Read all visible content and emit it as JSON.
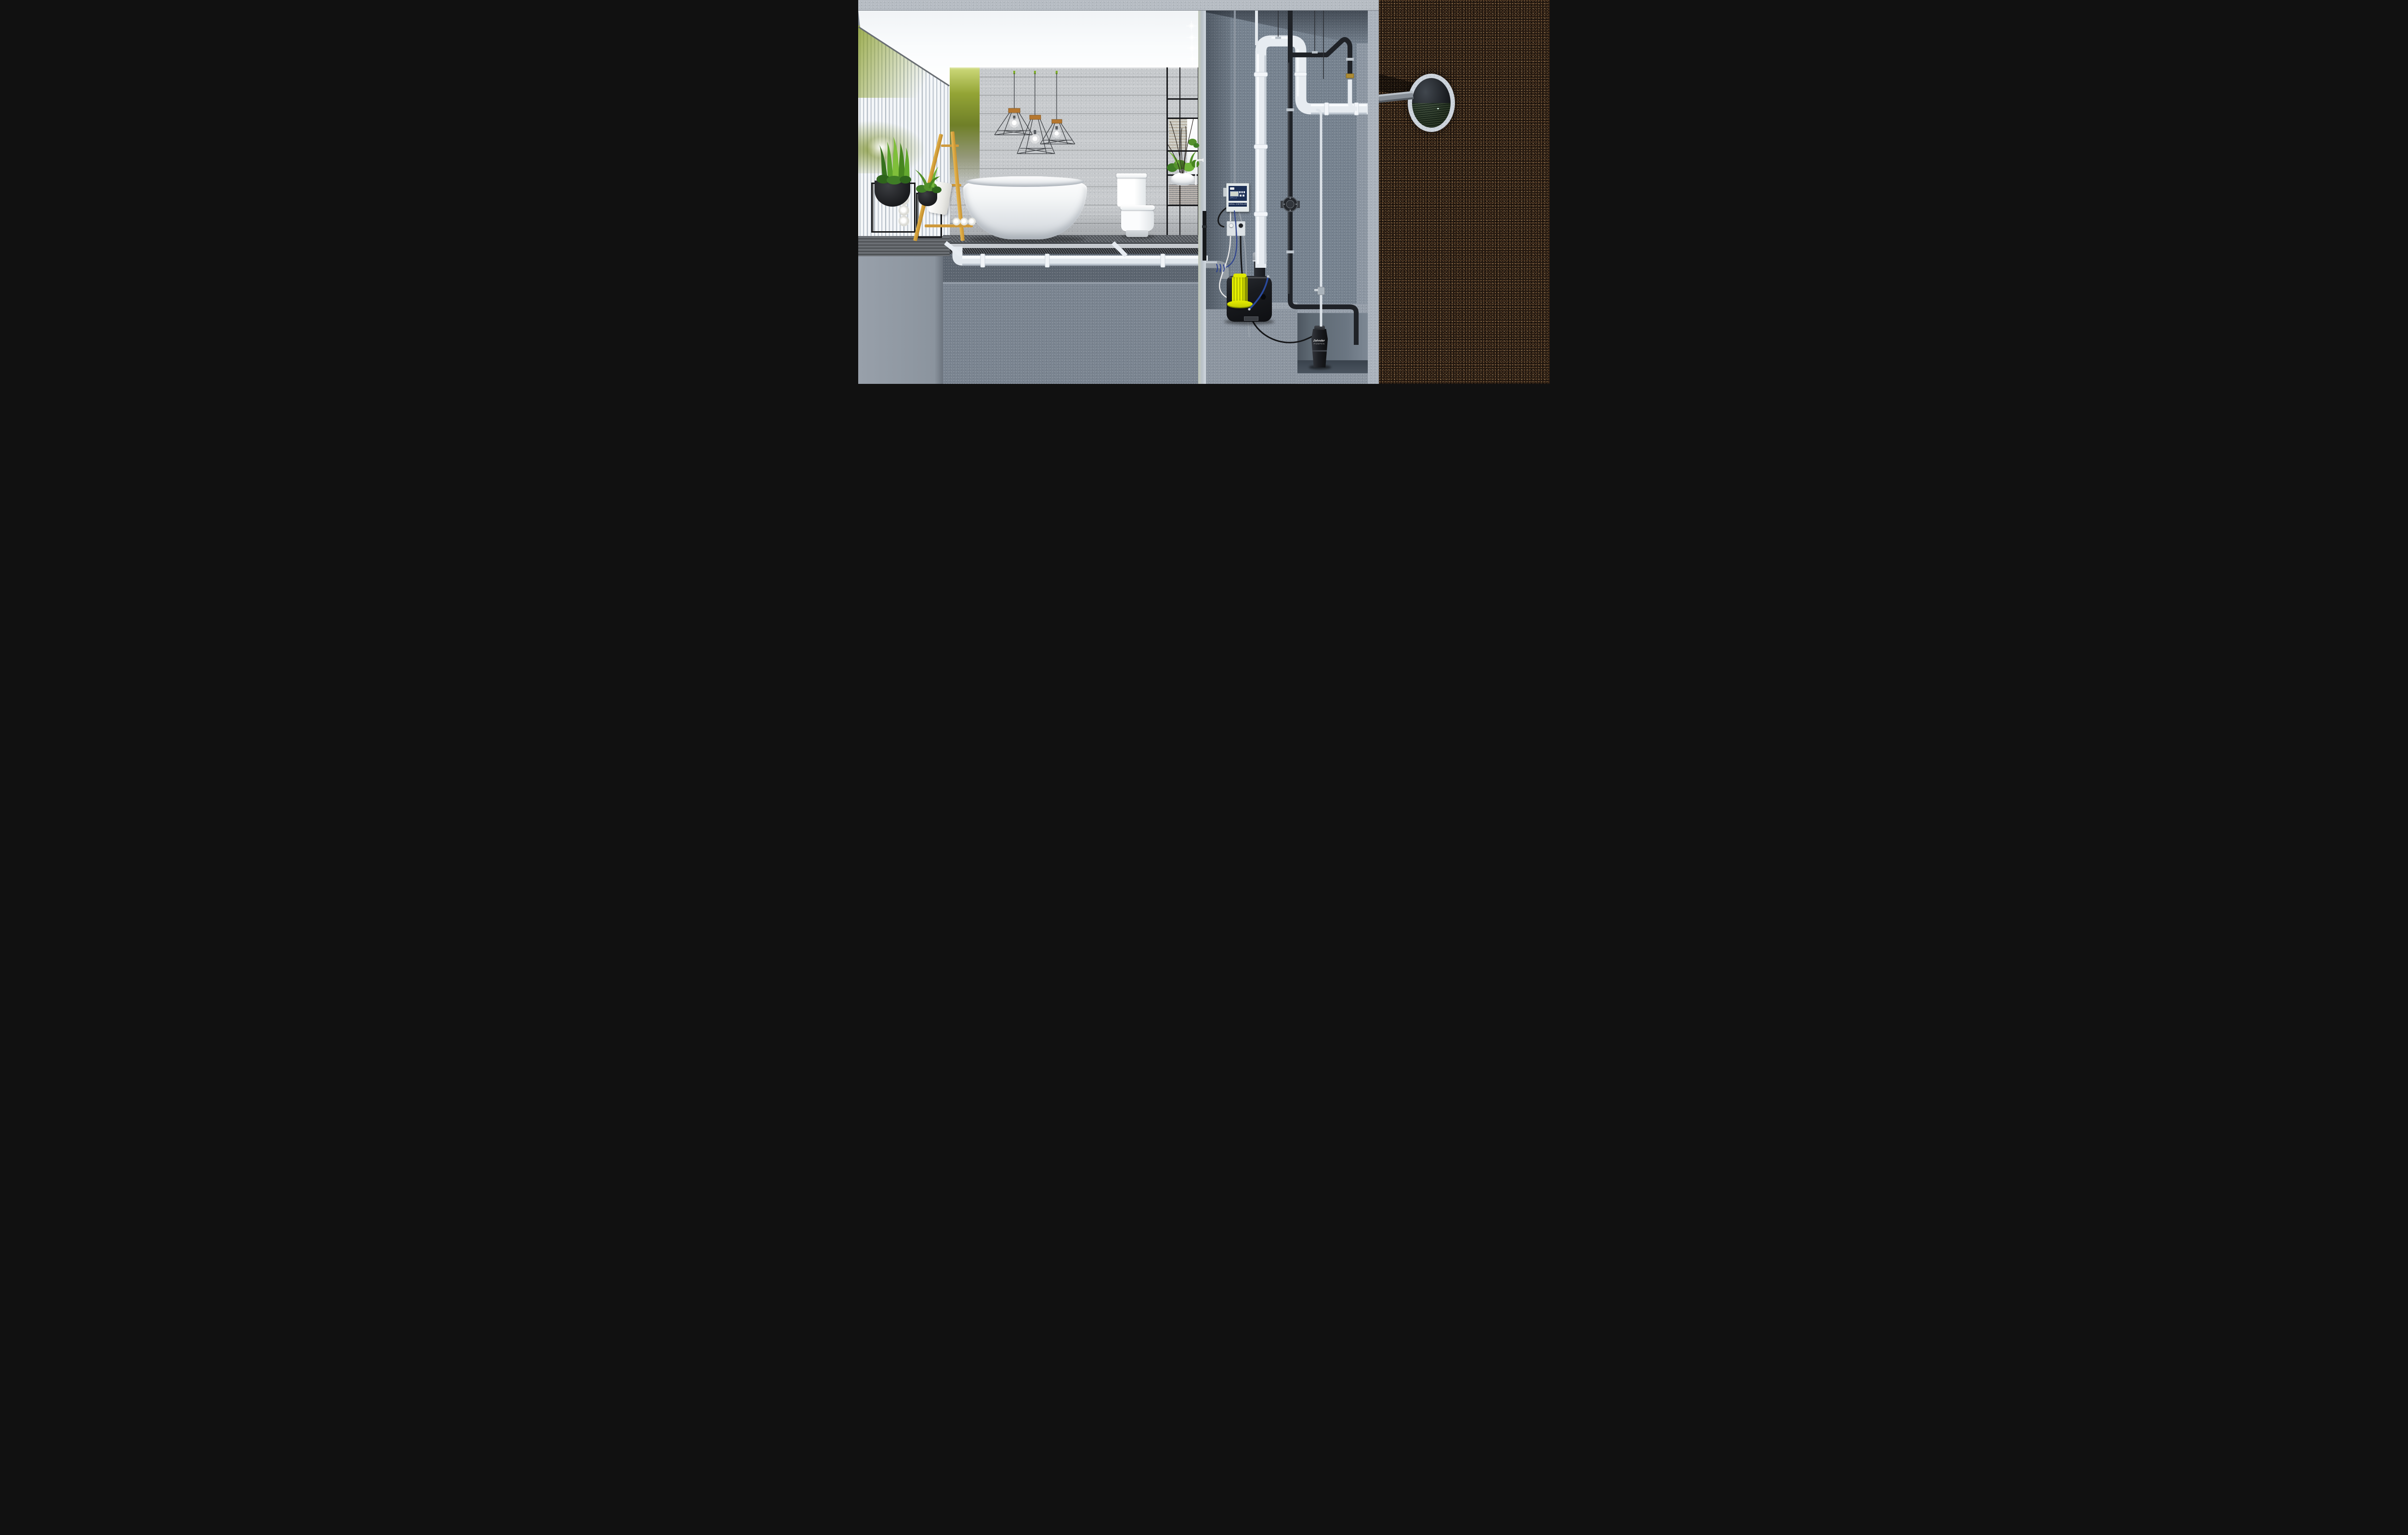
{
  "scene": {
    "description": "Photorealistic cutaway 3D render: modern bathroom above a basement pump shaft; a sewage lifting station pumps wastewater through a pipe loop into a buried sewer main shown in a soil cross-section",
    "regions": [
      "bathroom-interior",
      "under-floor-cross-section",
      "pump-shaft",
      "soil-cross-section"
    ]
  },
  "texts": {
    "controller_title": "NIVEAU- CONTROLLER",
    "controller_model": "ZPS 1.2",
    "pit_pump_brand": "Zehnder",
    "pit_pump_brand_sub": "PUMPEN"
  },
  "palette": {
    "soil": "#261a11",
    "concrete_wall": "#c6c9cc",
    "shaft_wall": "#76828f",
    "cut_face": "#a6aeb8",
    "ceiling": "#f4f6f8",
    "pipe_white": "#e9eef3",
    "pipe_black": "#202329",
    "pipe_gray": "#949ca4",
    "pump_body_black": "#17181b",
    "pump_motor_yellow": "#d8e000",
    "ladder_wood": "#d9a43b",
    "vanity_wood_dark": "#46332a",
    "shelf_wood_oak": "#cf9a3c",
    "plant_green": "#54912c",
    "sewage_water_green": "#33632c",
    "controller_navy": "#1c2f55",
    "towel_white": "#f1f1ee",
    "cable_blue": "#2a3f8f",
    "green_wall_glow": "#93a435"
  },
  "objects": [
    "freestanding-bathtub",
    "square-toilet",
    "pendant-cage-lamp x3",
    "recessed-spotlight x4",
    "corrugated-glass-wall",
    "green-accent-wall",
    "wooden-ladder-towel-rack",
    "towel-rolls",
    "bowl-planter-with-stand x2",
    "snake-plant",
    "fern",
    "vanity-shelf-frame",
    "vessel-sink",
    "wall-faucet",
    "decorative-twigs",
    "herringbone-wood-floor",
    "floor-drain-pipe",
    "level-controller-box",
    "wall-outlet x2",
    "sewage-lifting-station-pump",
    "yellow-pump-motor",
    "pressure-pipe-loop",
    "check-valve",
    "submersible-pit-pump",
    "thin-riser-pipe",
    "sewer-main-cross-section",
    "soil"
  ]
}
